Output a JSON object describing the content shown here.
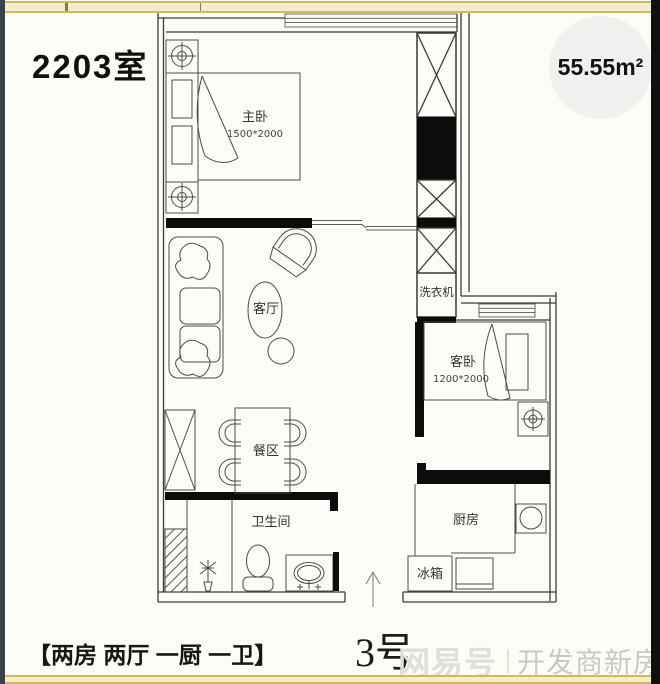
{
  "header": {
    "unit_title": "2203室",
    "area_value": "55.55",
    "area_unit": "m²"
  },
  "plan": {
    "entrance_label": "3号",
    "rooms": {
      "master_bedroom": {
        "label": "主卧",
        "size": "1500*2000"
      },
      "guest_bedroom": {
        "label": "客卧",
        "size": "1200*2000"
      },
      "living_room": {
        "label": "客厅"
      },
      "dining_area": {
        "label": "餐区"
      },
      "bathroom": {
        "label": "卫生间"
      },
      "kitchen": {
        "label": "厨房"
      },
      "appliances": {
        "washing_machine": "洗衣机",
        "fridge": "冰箱"
      }
    },
    "layout_summary": "两房 两厅 一厨 一卫"
  },
  "footer": {
    "summary": "【两房 两厅 一厨 一卫】",
    "watermark_logo": "网易号",
    "watermark_site": "开发商新房网"
  },
  "colors": {
    "accent_bar": "#d0ba5e",
    "accent_bar_fill": "#f3edcd",
    "side_strip": "#3d434b",
    "right_strip": "#101010",
    "circle_bg": "#f0f0ee",
    "wall_line": "#3a3a3a",
    "watermark_gray": "#c9c9c3"
  }
}
